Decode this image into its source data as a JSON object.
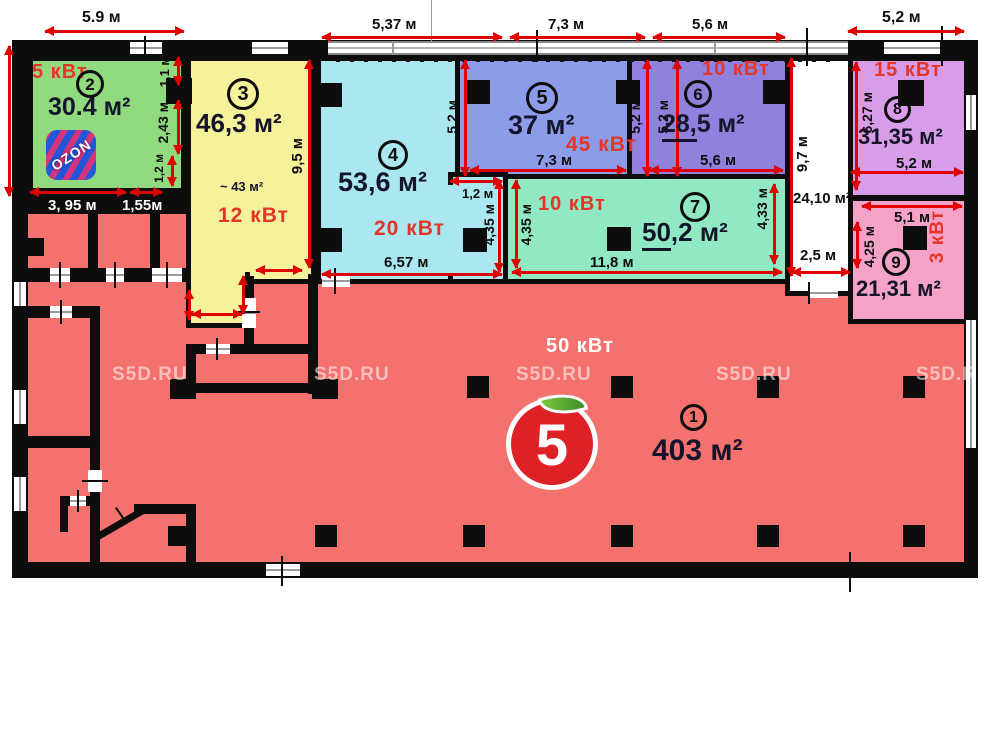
{
  "watermark": "S5D.RU",
  "colors": {
    "wall": "#0d0d0d",
    "dimension_arrow": "#e10000",
    "power_text": "#e53528",
    "room1_fill": "#f4716e",
    "room2_fill": "#90d97e",
    "room3_fill": "#f6f19b",
    "room4_fill": "#aae7f1",
    "room5_fill": "#8c9ce9",
    "room6_fill": "#8f81dc",
    "room7_fill": "#91e9c3",
    "room8_fill": "#d99ce8",
    "room9_fill": "#f5a2c9",
    "corridor_fill": "#ffffff"
  },
  "rooms": {
    "r1": {
      "number": "1",
      "area": "403 м²",
      "power": "50 кВт"
    },
    "r2": {
      "number": "2",
      "area": "30.4 м²",
      "power": "5 кВт"
    },
    "r3": {
      "number": "3",
      "area": "46,3 м²",
      "power": "12 кВт",
      "approx_area": "~ 43 м²"
    },
    "r4": {
      "number": "4",
      "area": "53,6 м²",
      "power": "20 кВт"
    },
    "r5": {
      "number": "5",
      "area": "37 м²",
      "power": "45 кВт"
    },
    "r6": {
      "number": "6",
      "area": "28,5 м²",
      "area_u": "28,",
      "area_t": "5 м²",
      "power": "10 кВт"
    },
    "r7": {
      "number": "7",
      "area": "50,2 м²",
      "area_u": "50",
      "area_t": ",2 м²",
      "power": "10 кВт"
    },
    "r8": {
      "number": "8",
      "area": "31,35 м²",
      "power": "15 кВт"
    },
    "r9": {
      "number": "9",
      "area": "21,31 м²",
      "power": "3 кВт"
    }
  },
  "corridor": {
    "length": "9,7 м",
    "area": "24,10 м²",
    "width": "2,5 м"
  },
  "dims": {
    "top_r2_width": "5.9 м",
    "top_r4_width": "5,37 м",
    "top_r5_width": "7,3 м",
    "top_r6_width": "5,6 м",
    "top_r8_width": "5,2 м",
    "r2_niche_h": "1,1 м",
    "r2_right_h": "2,43 м",
    "r2_door_h": "1,2 м",
    "r2_bottom_left": "3, 95 м",
    "r2_bottom_right": "1,55м",
    "r3_height": "9,5 м",
    "r4_bottom": "6,57 м",
    "r4_strip_w": "1,2 м",
    "r4_strip_h": "4,35 м",
    "r5_left_h": "5,2 м",
    "r5_right_h": "5,2 м",
    "r5_bottom": "7,3 м",
    "r6_left_h": "5,2 м",
    "r6_bottom": "5,6 м",
    "r7_left_h": "4,35 м",
    "r7_right_h": "4,33 м",
    "r7_bottom": "11,8 м",
    "r8_left_h": "6,27 м",
    "r8_bottom": "5,2 м",
    "r9_top": "5,1 м",
    "r9_left_h": "4,25 м"
  },
  "logos": {
    "ozon": "OZON",
    "pyaterochka": "5"
  }
}
